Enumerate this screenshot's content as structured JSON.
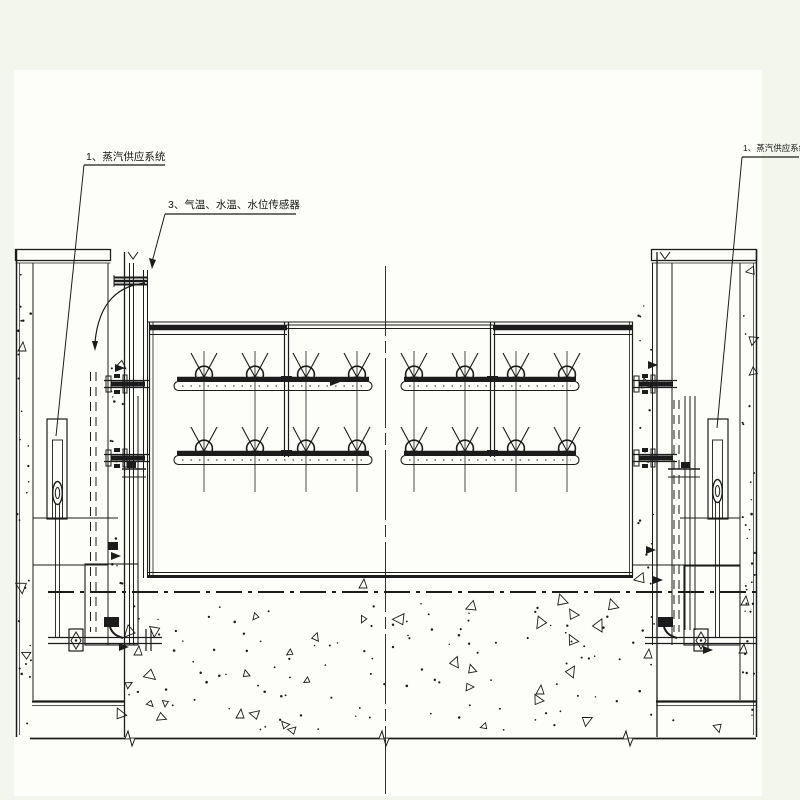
{
  "labels": {
    "steam_left": {
      "text": "1、蒸汽供应系统"
    },
    "steam_right": {
      "text": "1、蒸汽供应系统"
    },
    "sensors": {
      "text": "3、气温、水温、水位传感器"
    }
  },
  "colors": {
    "line": "#1c1c1c",
    "paper": "#fdfdfa",
    "margin": "#f3f6ec"
  },
  "spray_system": {
    "rows_y": [
      379,
      453
    ],
    "segments": [
      {
        "x1": 177,
        "x2": 369,
        "nozzle_x": [
          204,
          255,
          306,
          357
        ]
      },
      {
        "x1": 404,
        "x2": 576,
        "nozzle_x": [
          414,
          465,
          516,
          567
        ]
      }
    ],
    "nozzle_count": 16,
    "header_left": {
      "x1": 149,
      "x2": 287,
      "y": 327.5
    },
    "header_right": {
      "x1": 493,
      "x2": 632,
      "y": 327.5
    },
    "connector_x": [
      286.5,
      492.5
    ]
  },
  "stipple_regions": [
    {
      "x": 17,
      "y": 266,
      "w": 14,
      "h": 462,
      "dots": 26,
      "tris": 2
    },
    {
      "x": 109,
      "y": 266,
      "w": 14,
      "h": 324,
      "dots": 16,
      "tris": 1
    },
    {
      "x": 742,
      "y": 266,
      "w": 13,
      "h": 462,
      "dots": 26,
      "tris": 3
    },
    {
      "x": 636,
      "y": 266,
      "w": 18,
      "h": 324,
      "dots": 16,
      "tris": 2
    },
    {
      "x": 50,
      "y": 600,
      "w": 700,
      "h": 130,
      "dots": 130,
      "tris": 42
    }
  ],
  "triangle_marks": [
    [
      22,
      347
    ],
    [
      363,
      584
    ],
    [
      745,
      601
    ],
    [
      743,
      649
    ],
    [
      648,
      654
    ],
    [
      138,
      651
    ],
    [
      240,
      714
    ],
    [
      540,
      690
    ]
  ],
  "wedge_marks": [
    [
      120,
      368
    ],
    [
      116,
      556
    ],
    [
      653,
      365
    ],
    [
      651,
      550
    ],
    [
      124,
      647
    ],
    [
      708,
      650
    ],
    [
      335,
      382
    ],
    [
      658,
      580
    ]
  ]
}
